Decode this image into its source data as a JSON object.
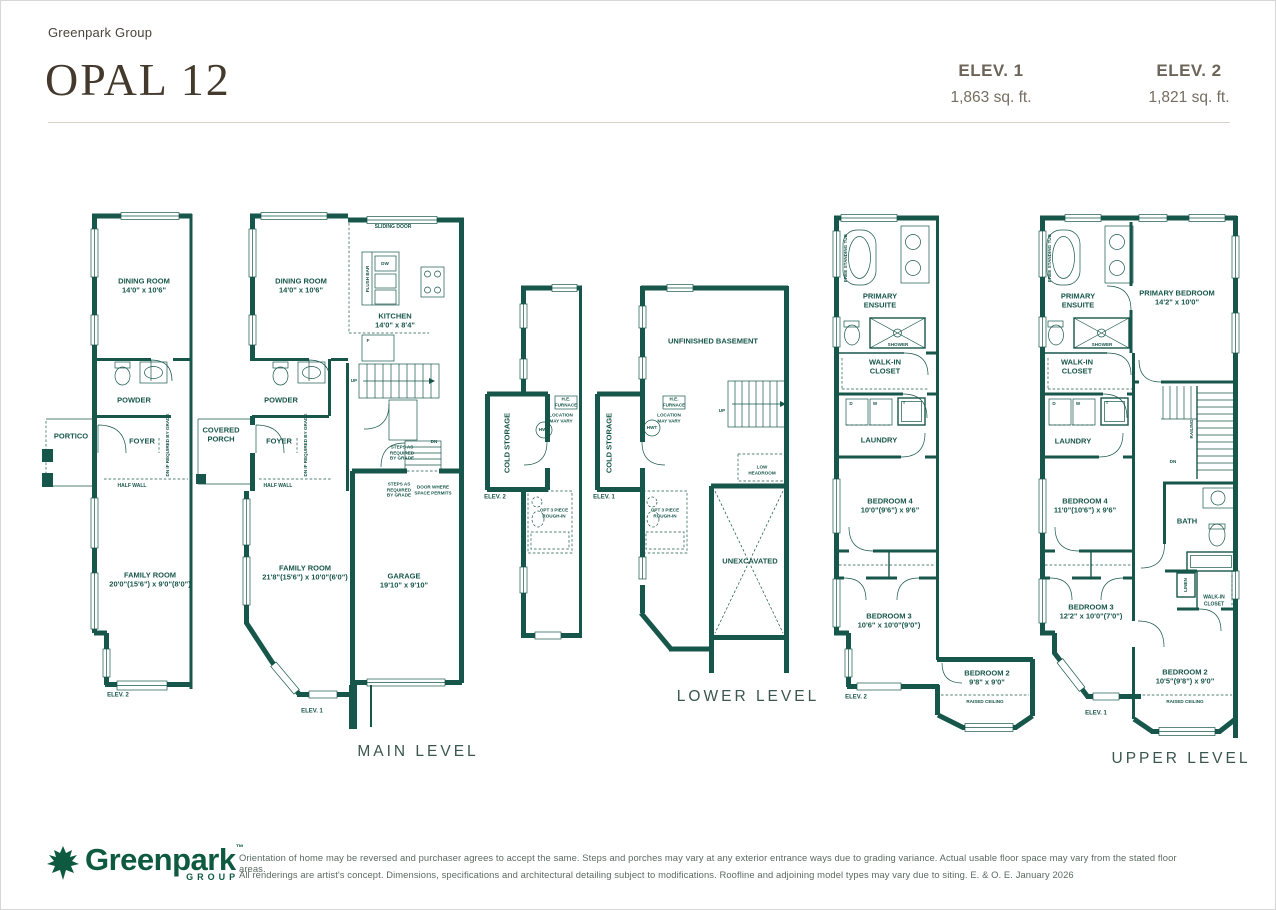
{
  "header": {
    "brand": "Greenpark Group",
    "model_name": "OPAL 12",
    "elevations": [
      {
        "label": "ELEV. 1",
        "area": "1,863 sq. ft."
      },
      {
        "label": "ELEV. 2",
        "area": "1,821 sq. ft."
      }
    ]
  },
  "colors": {
    "wall_teal": "#17564A",
    "title_brown": "#44392D",
    "elev_gray": "#6D6459",
    "logo_green": "#0D5A40",
    "disclaimer_gray": "#5B6A62"
  },
  "main_level": {
    "title": "MAIN LEVEL",
    "elev2_plan": {
      "dining": "DINING ROOM\n14'0\" x 10'6\"",
      "powder": "POWDER",
      "portico": "PORTICO",
      "foyer": "FOYER",
      "dn_note": "DN IF REQUIRED BY GRADE",
      "half_wall": "HALF WALL",
      "family": "FAMILY ROOM\n20'0\"(15'6\") x 9'0\"(8'0\")",
      "elev_tag": "ELEV. 2"
    },
    "elev1_plan": {
      "dining": "DINING ROOM\n14'0\" x 10'6\"",
      "sliding_door": "SLIDING DOOR",
      "flush_bar": "FLUSH BAR",
      "dw": "DW",
      "fridge": "F",
      "kitchen": "KITCHEN\n14'0\" x 8'4\"",
      "up": "UP",
      "dn": "DN",
      "stairs_note": "STEPS AS\nREQUIRED\nBY GRADE",
      "powder": "POWDER",
      "covered_porch": "COVERED\nPORCH",
      "foyer": "FOYER",
      "dn_note": "DN IF REQUIRED BY GRADE",
      "half_wall": "HALF WALL",
      "family": "FAMILY ROOM\n21'8\"(15'6\") x 10'0\"(6'0\")",
      "garage": "GARAGE\n19'10\" x 9'10\"",
      "steps_note": "STEPS AS\nREQUIRED\nBY GRADE",
      "door_note": "DOOR WHERE\nSPACE PERMITS",
      "elev_tag": "ELEV. 1"
    }
  },
  "lower_level": {
    "title": "LOWER LEVEL",
    "elev2_plan": {
      "cold_storage": "COLD STORAGE",
      "elev_tag": "ELEV. 2",
      "furnace": "H.E.\nFURNACE",
      "location": "LOCATION\nMAY VARY",
      "hwt": "HWT",
      "opt_bath": "OPT 3 PIECE\nROUGH-IN"
    },
    "elev1_plan": {
      "unfinished": "UNFINISHED BASEMENT",
      "cold_storage": "COLD STORAGE",
      "elev_tag": "ELEV. 1",
      "furnace": "H.E.\nFURNACE",
      "location": "LOCATION\nMAY VARY",
      "hwt": "HWT",
      "up": "UP",
      "low_headroom": "LOW\nHEADROOM",
      "opt_bath": "OPT 3 PIECE\nROUGH-IN",
      "unexcavated": "UNEXCAVATED"
    }
  },
  "upper_level": {
    "title": "UPPER LEVEL",
    "elev2_plan": {
      "tub": "FREE STANDING TUB",
      "ensuite": "PRIMARY\nENSUITE",
      "shower": "SHOWER",
      "walk_in": "WALK-IN\nCLOSET",
      "d": "D",
      "w": "W",
      "t": "T",
      "laundry": "LAUNDRY",
      "bed4": "BEDROOM 4\n10'0\"(9'6\") x 9'6\"",
      "bed3": "BEDROOM 3\n10'6\" x 10'0\"(9'0\")",
      "bed2": "BEDROOM 2\n9'8\" x 9'0\"",
      "raised": "RAISED CEILING",
      "elev_tag": "ELEV. 2"
    },
    "elev1_plan": {
      "tub": "FREE STANDING TUB",
      "ensuite": "PRIMARY\nENSUITE",
      "primary_bed": "PRIMARY BEDROOM\n14'2\" x 10'0\"",
      "shower": "SHOWER",
      "walk_in": "WALK-IN\nCLOSET",
      "d": "D",
      "w": "W",
      "t": "T",
      "laundry": "LAUNDRY",
      "railing": "RAILING",
      "dn": "DN",
      "bath": "BATH",
      "linen": "LINEN",
      "walk_in2": "WALK-IN\nCLOSET",
      "bed4": "BEDROOM 4\n11'0\"(10'6\") x 9'6\"",
      "bed3": "BEDROOM 3\n12'2\" x 10'0\"(7'0\")",
      "bed2": "BEDROOM 2\n10'5\"(9'8\") x 9'0\"",
      "raised": "RAISED CEILING",
      "elev_tag": "ELEV. 1"
    }
  },
  "footer": {
    "logo_text": "Greenpark",
    "logo_sub": "GROUP",
    "logo_tm": "™",
    "disclaimer_line1": "Orientation of home may be reversed and purchaser agrees to accept the same. Steps and porches may vary at any exterior entrance ways due to grading variance. Actual usable floor space may vary from the stated floor areas.",
    "disclaimer_line2": "All renderings are artist's concept. Dimensions, specifications and architectural detailing subject to modifications. Roofline and adjoining model types may vary due to siting. E. & O. E. January 2026"
  }
}
